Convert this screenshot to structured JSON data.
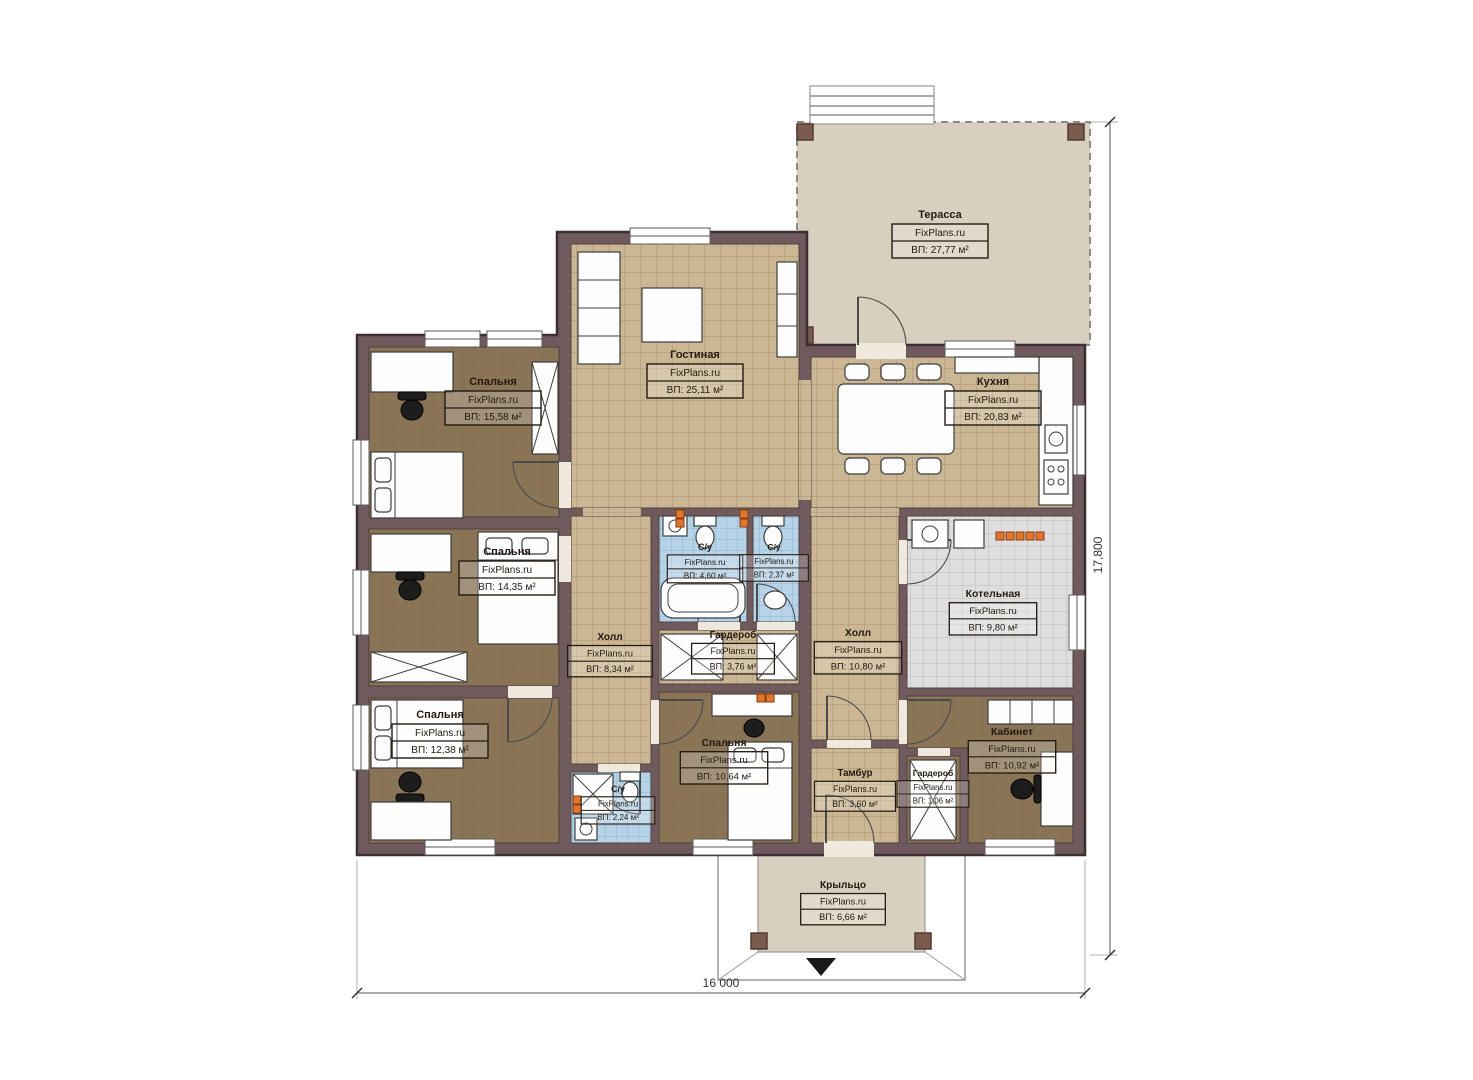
{
  "plan": {
    "brand": "FixPlans.ru",
    "dimensions": {
      "width_label": "16 000",
      "height_label": "17,800"
    },
    "colors": {
      "wall": "#6f5a5e",
      "wall_outline": "#3c2f33",
      "floor_tile_tan": "#cbb793",
      "floor_carpet_brown": "#8a7456",
      "floor_tile_blue": "#b7d3e8",
      "floor_tile_gray": "#dedede",
      "terrace_beige": "#d8cfbe",
      "vent_orange": "#e0762e",
      "post_brown": "#7b5b4e"
    },
    "rooms": [
      {
        "id": "terrace",
        "name": "Терасса",
        "brand": "FixPlans.ru",
        "area": "ВП: 27,77 м²"
      },
      {
        "id": "living",
        "name": "Гостиная",
        "brand": "FixPlans.ru",
        "area": "ВП: 25,11 м²"
      },
      {
        "id": "kitchen",
        "name": "Кухня",
        "brand": "FixPlans.ru",
        "area": "ВП: 20,83 м²"
      },
      {
        "id": "bedroom1",
        "name": "Спальня",
        "brand": "FixPlans.ru",
        "area": "ВП: 15,58 м²"
      },
      {
        "id": "bedroom2",
        "name": "Спальня",
        "brand": "FixPlans.ru",
        "area": "ВП: 14,35 м²"
      },
      {
        "id": "bedroom3",
        "name": "Спальня",
        "brand": "FixPlans.ru",
        "area": "ВП: 12,38 м²"
      },
      {
        "id": "bathroom1",
        "name": "С/у",
        "brand": "FixPlans.ru",
        "area": "ВП: 4,60 м²"
      },
      {
        "id": "bathroom2",
        "name": "С/у",
        "brand": "FixPlans.ru",
        "area": "ВП: 2,37 м²"
      },
      {
        "id": "hall-left",
        "name": "Холл",
        "brand": "FixPlans.ru",
        "area": "ВП: 8,34 м²"
      },
      {
        "id": "wardrobe-mid",
        "name": "Гардероб",
        "brand": "FixPlans.ru",
        "area": "ВП: 3,76 м²"
      },
      {
        "id": "hall-right",
        "name": "Холл",
        "brand": "FixPlans.ru",
        "area": "ВП: 10,80 м²"
      },
      {
        "id": "boiler",
        "name": "Котельная",
        "brand": "FixPlans.ru",
        "area": "ВП: 9,80 м²"
      },
      {
        "id": "office",
        "name": "Кабинет",
        "brand": "FixPlans.ru",
        "area": "ВП: 10,92 м²"
      },
      {
        "id": "bedroom4",
        "name": "Спальня",
        "brand": "FixPlans.ru",
        "area": "ВП: 10,64 м²"
      },
      {
        "id": "bathroom3",
        "name": "С/у",
        "brand": "FixPlans.ru",
        "area": "ВП: 2,24 м²"
      },
      {
        "id": "tambour",
        "name": "Тамбур",
        "brand": "FixPlans.ru",
        "area": "ВП: 3,60 м²"
      },
      {
        "id": "wardrobe2",
        "name": "Гардероб",
        "brand": "FixPlans.ru",
        "area": "ВП: 1,06 м²"
      },
      {
        "id": "porch",
        "name": "Крыльцо",
        "brand": "FixPlans.ru",
        "area": "ВП: 6,66 м²"
      }
    ]
  }
}
